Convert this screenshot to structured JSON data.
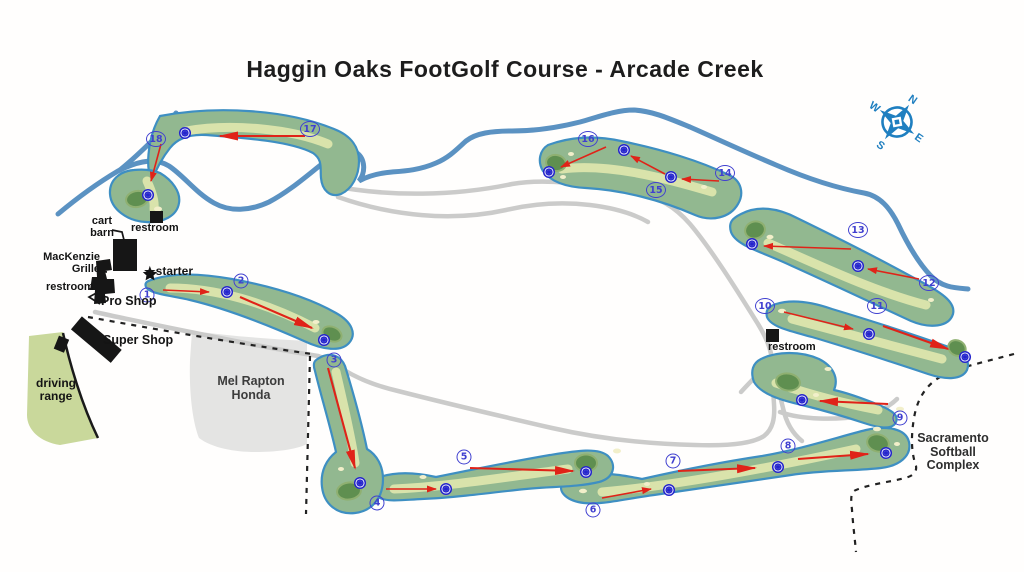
{
  "title": "Haggin Oaks FootGolf Course - Arcade Creek",
  "compass": {
    "n": "N",
    "e": "E",
    "s": "S",
    "w": "W"
  },
  "labels": {
    "cart_barn": [
      "cart",
      "barn"
    ],
    "restroom_top": "restroom",
    "mackenzie": [
      "MacKenzie",
      "Grille"
    ],
    "restroom_left": "restroom",
    "pro_shop": "Pro Shop",
    "star": "★",
    "starter": "starter",
    "super_shop": "Super Shop",
    "driving_range": [
      "driving",
      "range"
    ],
    "mel_rapton_honda": [
      "Mel Rapton",
      "Honda"
    ],
    "restroom_right": "restroom",
    "softball_complex": [
      "Sacramento",
      "Softball",
      "Complex"
    ]
  },
  "colors": {
    "creek": "#5b92c2",
    "fairway": "#92b890",
    "fairway_cut": "#d9e3ab",
    "putting_green": "#5f8f50",
    "fairway_outline": "#3e8fc2",
    "cart_path": "#cbcbca",
    "arrow_red": "#e02318",
    "hole_number_blue": "#4040d0",
    "compass_blue": "#1f7fc0"
  },
  "holes": [
    {
      "n": 1,
      "label": [
        147,
        295
      ],
      "arrow": [
        163,
        290,
        209,
        292
      ],
      "target": [
        227,
        292
      ],
      "big": false
    },
    {
      "n": 2,
      "label": [
        241,
        281
      ],
      "arrow": [
        240,
        297,
        312,
        328
      ],
      "target": [
        324,
        340
      ],
      "big": true
    },
    {
      "n": 3,
      "label": [
        334,
        360
      ],
      "arrow": [
        328,
        368,
        355,
        468
      ],
      "target": [
        360,
        483
      ],
      "big": true
    },
    {
      "n": 4,
      "label": [
        377,
        503
      ],
      "arrow": [
        386,
        489,
        436,
        489
      ],
      "target": [
        446,
        489
      ],
      "big": false
    },
    {
      "n": 5,
      "label": [
        464,
        457
      ],
      "arrow": [
        470,
        468,
        573,
        471
      ],
      "target": [
        586,
        472
      ],
      "big": true
    },
    {
      "n": 6,
      "label": [
        593,
        510
      ],
      "arrow": [
        602,
        498,
        651,
        489
      ],
      "target": [
        669,
        490
      ],
      "big": false
    },
    {
      "n": 7,
      "label": [
        673,
        461
      ],
      "arrow": [
        678,
        471,
        755,
        468
      ],
      "target": [
        778,
        467
      ],
      "big": true
    },
    {
      "n": 8,
      "label": [
        788,
        446
      ],
      "arrow": [
        798,
        459,
        868,
        454
      ],
      "target": [
        886,
        453
      ],
      "big": true
    },
    {
      "n": 9,
      "label": [
        900,
        418
      ],
      "arrow": [
        888,
        404,
        820,
        401
      ],
      "target": [
        802,
        400
      ],
      "big": true
    },
    {
      "n": 10,
      "label": [
        765,
        306
      ],
      "arrow": [
        784,
        312,
        853,
        329
      ],
      "target": [
        869,
        334
      ],
      "big": false
    },
    {
      "n": 11,
      "label": [
        877,
        306
      ],
      "arrow": [
        883,
        326,
        948,
        349
      ],
      "target": [
        965,
        357
      ],
      "big": true
    },
    {
      "n": 12,
      "label": [
        929,
        283
      ],
      "arrow": [
        919,
        279,
        868,
        269
      ],
      "target": [
        858,
        266
      ],
      "big": false
    },
    {
      "n": 13,
      "label": [
        858,
        230
      ],
      "arrow": [
        851,
        249,
        764,
        246
      ],
      "target": [
        752,
        244
      ],
      "big": false
    },
    {
      "n": 14,
      "label": [
        725,
        173
      ],
      "arrow": [
        719,
        181,
        682,
        179
      ],
      "target": [
        671,
        177
      ],
      "big": false
    },
    {
      "n": 15,
      "label": [
        656,
        190
      ],
      "arrow": [
        665,
        174,
        631,
        156
      ],
      "target": [
        624,
        150
      ],
      "big": false
    },
    {
      "n": 16,
      "label": [
        588,
        139
      ],
      "arrow": [
        606,
        147,
        561,
        167
      ],
      "target": [
        549,
        172
      ],
      "big": false
    },
    {
      "n": 17,
      "label": [
        310,
        129
      ],
      "arrow": [
        305,
        136,
        220,
        136
      ],
      "target": [
        185,
        133
      ],
      "big": true
    },
    {
      "n": 18,
      "label": [
        156,
        139
      ],
      "arrow": [
        161,
        144,
        151,
        181
      ],
      "target": [
        148,
        195
      ],
      "big": false
    }
  ]
}
